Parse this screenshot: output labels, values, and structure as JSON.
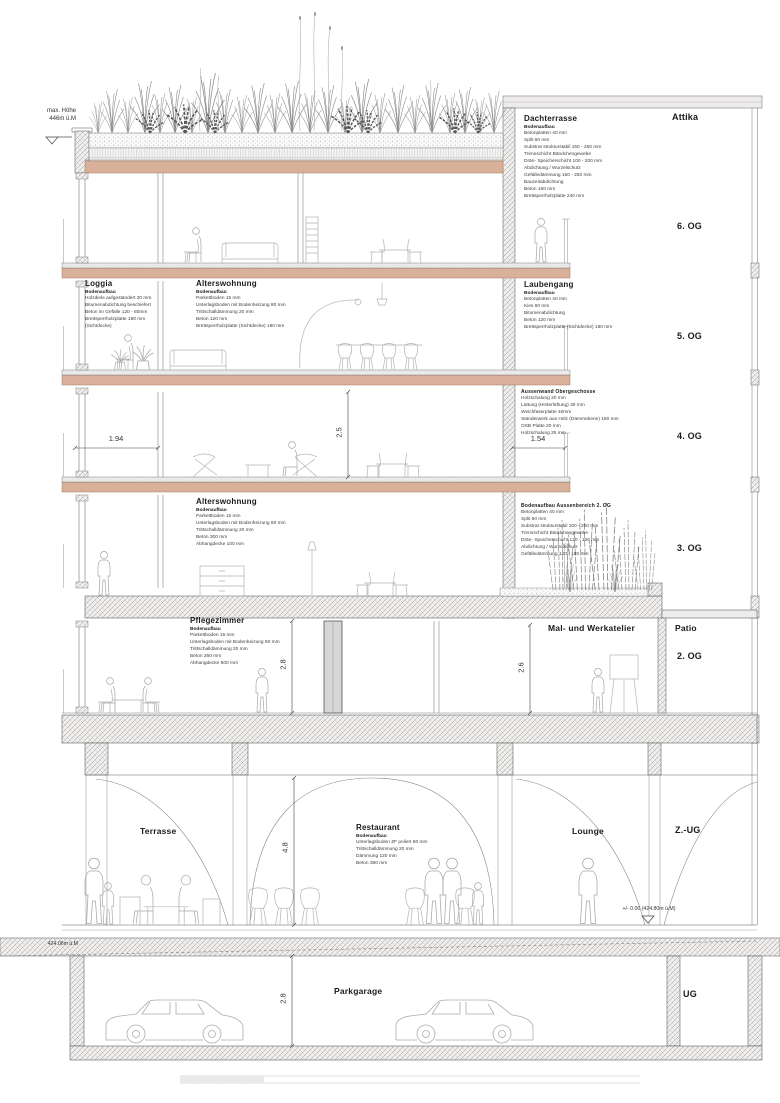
{
  "levels": {
    "attika": "Attika",
    "og6": "6. OG",
    "og5": "5. OG",
    "og4": "4. OG",
    "og3": "3. OG",
    "og2": "2. OG",
    "zug": "Z.-UG",
    "ug": "UG"
  },
  "rooms": {
    "patio": "Patio",
    "mal_werkatelier": "Mal- und Werkatelier",
    "terrasse": "Terrasse",
    "lounge": "Lounge",
    "parkgarage": "Parkgarage"
  },
  "markers": {
    "max_height_line1": "max. Höhe",
    "max_height_line2": "446m ü.M",
    "zero_level": "+/- 0.00 (424.80m ü.M)",
    "terrain_level": "424.06m ü.M"
  },
  "dimensions": {
    "loggia_width": "1.94",
    "laubengang_width": "1.54",
    "og4_height": "2.5",
    "og2_left_height": "2.8",
    "og2_right_height": "2.6",
    "zug_height": "4.8",
    "ug_height": "2.8"
  },
  "colors": {
    "wood_slab": "#d9b19b"
  },
  "specs": {
    "dachterrasse": {
      "title": "Dachterrasse",
      "subtitle": "Bodenaufbau",
      "lines": [
        "Betonplatten 40 mm",
        "Split 60 mm",
        "Substrat strukturstabil 150 - 250 mm",
        "Trennschicht Bändchengewebe",
        "Drän- Speicherschicht 100 - 200 mm",
        "Abdichtung / Wurzelschutz",
        "Gefälledämmung 150 - 250 mm",
        "Bauzeitabdichtung",
        "Beton 160 mm",
        "Brettsperrholzplatte 240 mm"
      ]
    },
    "loggia": {
      "title": "Loggia",
      "subtitle": "Bodenaufbau",
      "lines": [
        "Holzdiele aufgeständert 20 mm",
        "Bitumenabdichtung beschiefert",
        "Beton im Gefälle 120 - 80mm",
        "Brettsperrholzplatte 180 mm",
        "(Sichtdecke)"
      ]
    },
    "alterswohnung_5og": {
      "title": "Alterswohnung",
      "subtitle": "Bodenaufbau",
      "lines": [
        "Parkettboden 15 mm",
        "Unterlagsboden mit Bodenheizung 80 mm",
        "Trittschalldämmung 20 mm",
        "Beton 120 mm",
        "Brettsperrholzplatte (Sichtdecke) 180 mm"
      ]
    },
    "laubengang": {
      "title": "Laubengang",
      "subtitle": "Bodenaufbau",
      "lines": [
        "Betonplatten 40 mm",
        "Kies 60 mm",
        "Bitumenabdichtung",
        "Beton 120 mm",
        "Brettsperrholzplatte (Sichtdecke) 180 mm"
      ]
    },
    "aussenwand": {
      "title": "Aussenwand Obergeschosse",
      "lines": [
        "Holzschalung 20 mm",
        "Lattung (Hinterlüftung) 30 mm",
        "Weichfaserplatte 40mm",
        "Ständerwerk aus Holz (Dämmebene) 180 mm",
        "OSB Platte 20 mm",
        "Holzschalung 25 mm"
      ]
    },
    "alterswohnung_3og": {
      "title": "Alterswohnung",
      "subtitle": "Bodenaufbau",
      "lines": [
        "Parkettboden 15 mm",
        "Unterlagsboden mit Bodenheizung 80 mm",
        "Trittschalldämmung 20 mm",
        "Beton 300 mm",
        "Abhangdecke 100 mm"
      ]
    },
    "aussenbereich_2og": {
      "title": "Bodenaufbau Aussenbereich 2. OG",
      "lines": [
        "Betonplatten 40 mm",
        "Split 60 mm",
        "Substrat strukturstabil 100 - 200 mm",
        "Trennschicht Bändchengewebe",
        "Drän- Speicherschicht 120 - 100 mm",
        "Abdichtung / Wurzelschutz",
        "Gefälledämmung 120 - 180 mm"
      ]
    },
    "pflegezimmer": {
      "title": "Pflegezimmer",
      "subtitle": "Bodenaufbau",
      "lines": [
        "Parkettboden 15 mm",
        "Unterlagsboden mit Bodenheizung 80 mm",
        "Trittschalldämmung 20 mm",
        "Beton 260 mm",
        "Abhangdecke 500 mm"
      ]
    },
    "restaurant": {
      "title": "Restaurant",
      "subtitle": "Bodenaufbau",
      "lines": [
        "Unterlagsboden ZF poliert 80 mm",
        "Trittschalldämmung 20 mm",
        "Dämmung 120 mm",
        "Beton 380 mm"
      ]
    }
  }
}
